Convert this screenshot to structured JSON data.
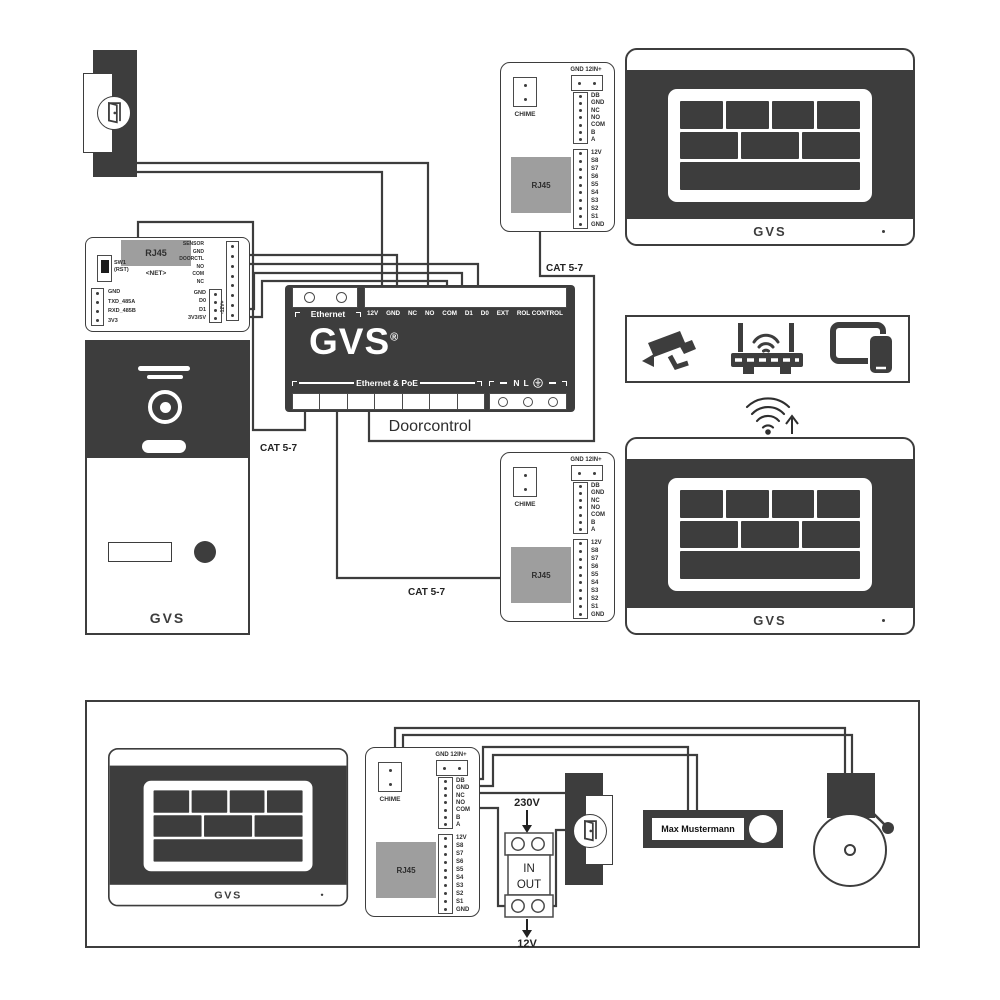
{
  "colors": {
    "device_dark": "#3d3d3d",
    "connector_gray": "#9e9e9e",
    "wire": "#3d3d3d"
  },
  "net_module": {
    "rj45": "RJ45",
    "net": "<NET>",
    "sw1": "SW1",
    "rst": "(RST)",
    "left_pins": [
      "GND",
      "TXD_485A",
      "RXD_485B",
      "3V3"
    ],
    "io_pins": [
      "SENSOR",
      "GND",
      "DOORCTL",
      "NO",
      "COM",
      "NC"
    ],
    "bus_pins": [
      "GND",
      "D0",
      "D1",
      "3V3/5V"
    ],
    "power_vertical": "-12V+"
  },
  "door_station": {
    "logo": "GVS"
  },
  "doorcontrol": {
    "ethernet_label": "Ethernet",
    "terminals": [
      "12V",
      "GND",
      "NC",
      "NO",
      "COM",
      "D1",
      "D0",
      "EXT",
      "ROL CONTROL"
    ],
    "logo": "GVS",
    "reg": "®",
    "poe_label": "Ethernet & PoE",
    "mains_n": "N",
    "mains_l": "L",
    "title": "Doorcontrol"
  },
  "chime_module": {
    "chime": "CHIME",
    "power": "GND 12IN+",
    "rj45": "RJA5_PLACEHOLDER",
    "bus_pins": [
      "DB",
      "GND",
      "NC",
      "NO",
      "COM",
      "B",
      "A"
    ],
    "switch_pins": [
      "12V",
      "S8",
      "S7",
      "S6",
      "S5",
      "S4",
      "S3",
      "S2",
      "S1",
      "GND"
    ]
  },
  "monitor": {
    "logo": "GVS"
  },
  "cables": {
    "cat1": "CAT 5-7",
    "cat2": "CAT 5-7",
    "cat3": "CAT 5-7"
  },
  "psu": {
    "input": "230V",
    "line1": "IN",
    "line2": "OUT",
    "output": "12V"
  },
  "nameplate": {
    "name": "Max Mustermann"
  }
}
